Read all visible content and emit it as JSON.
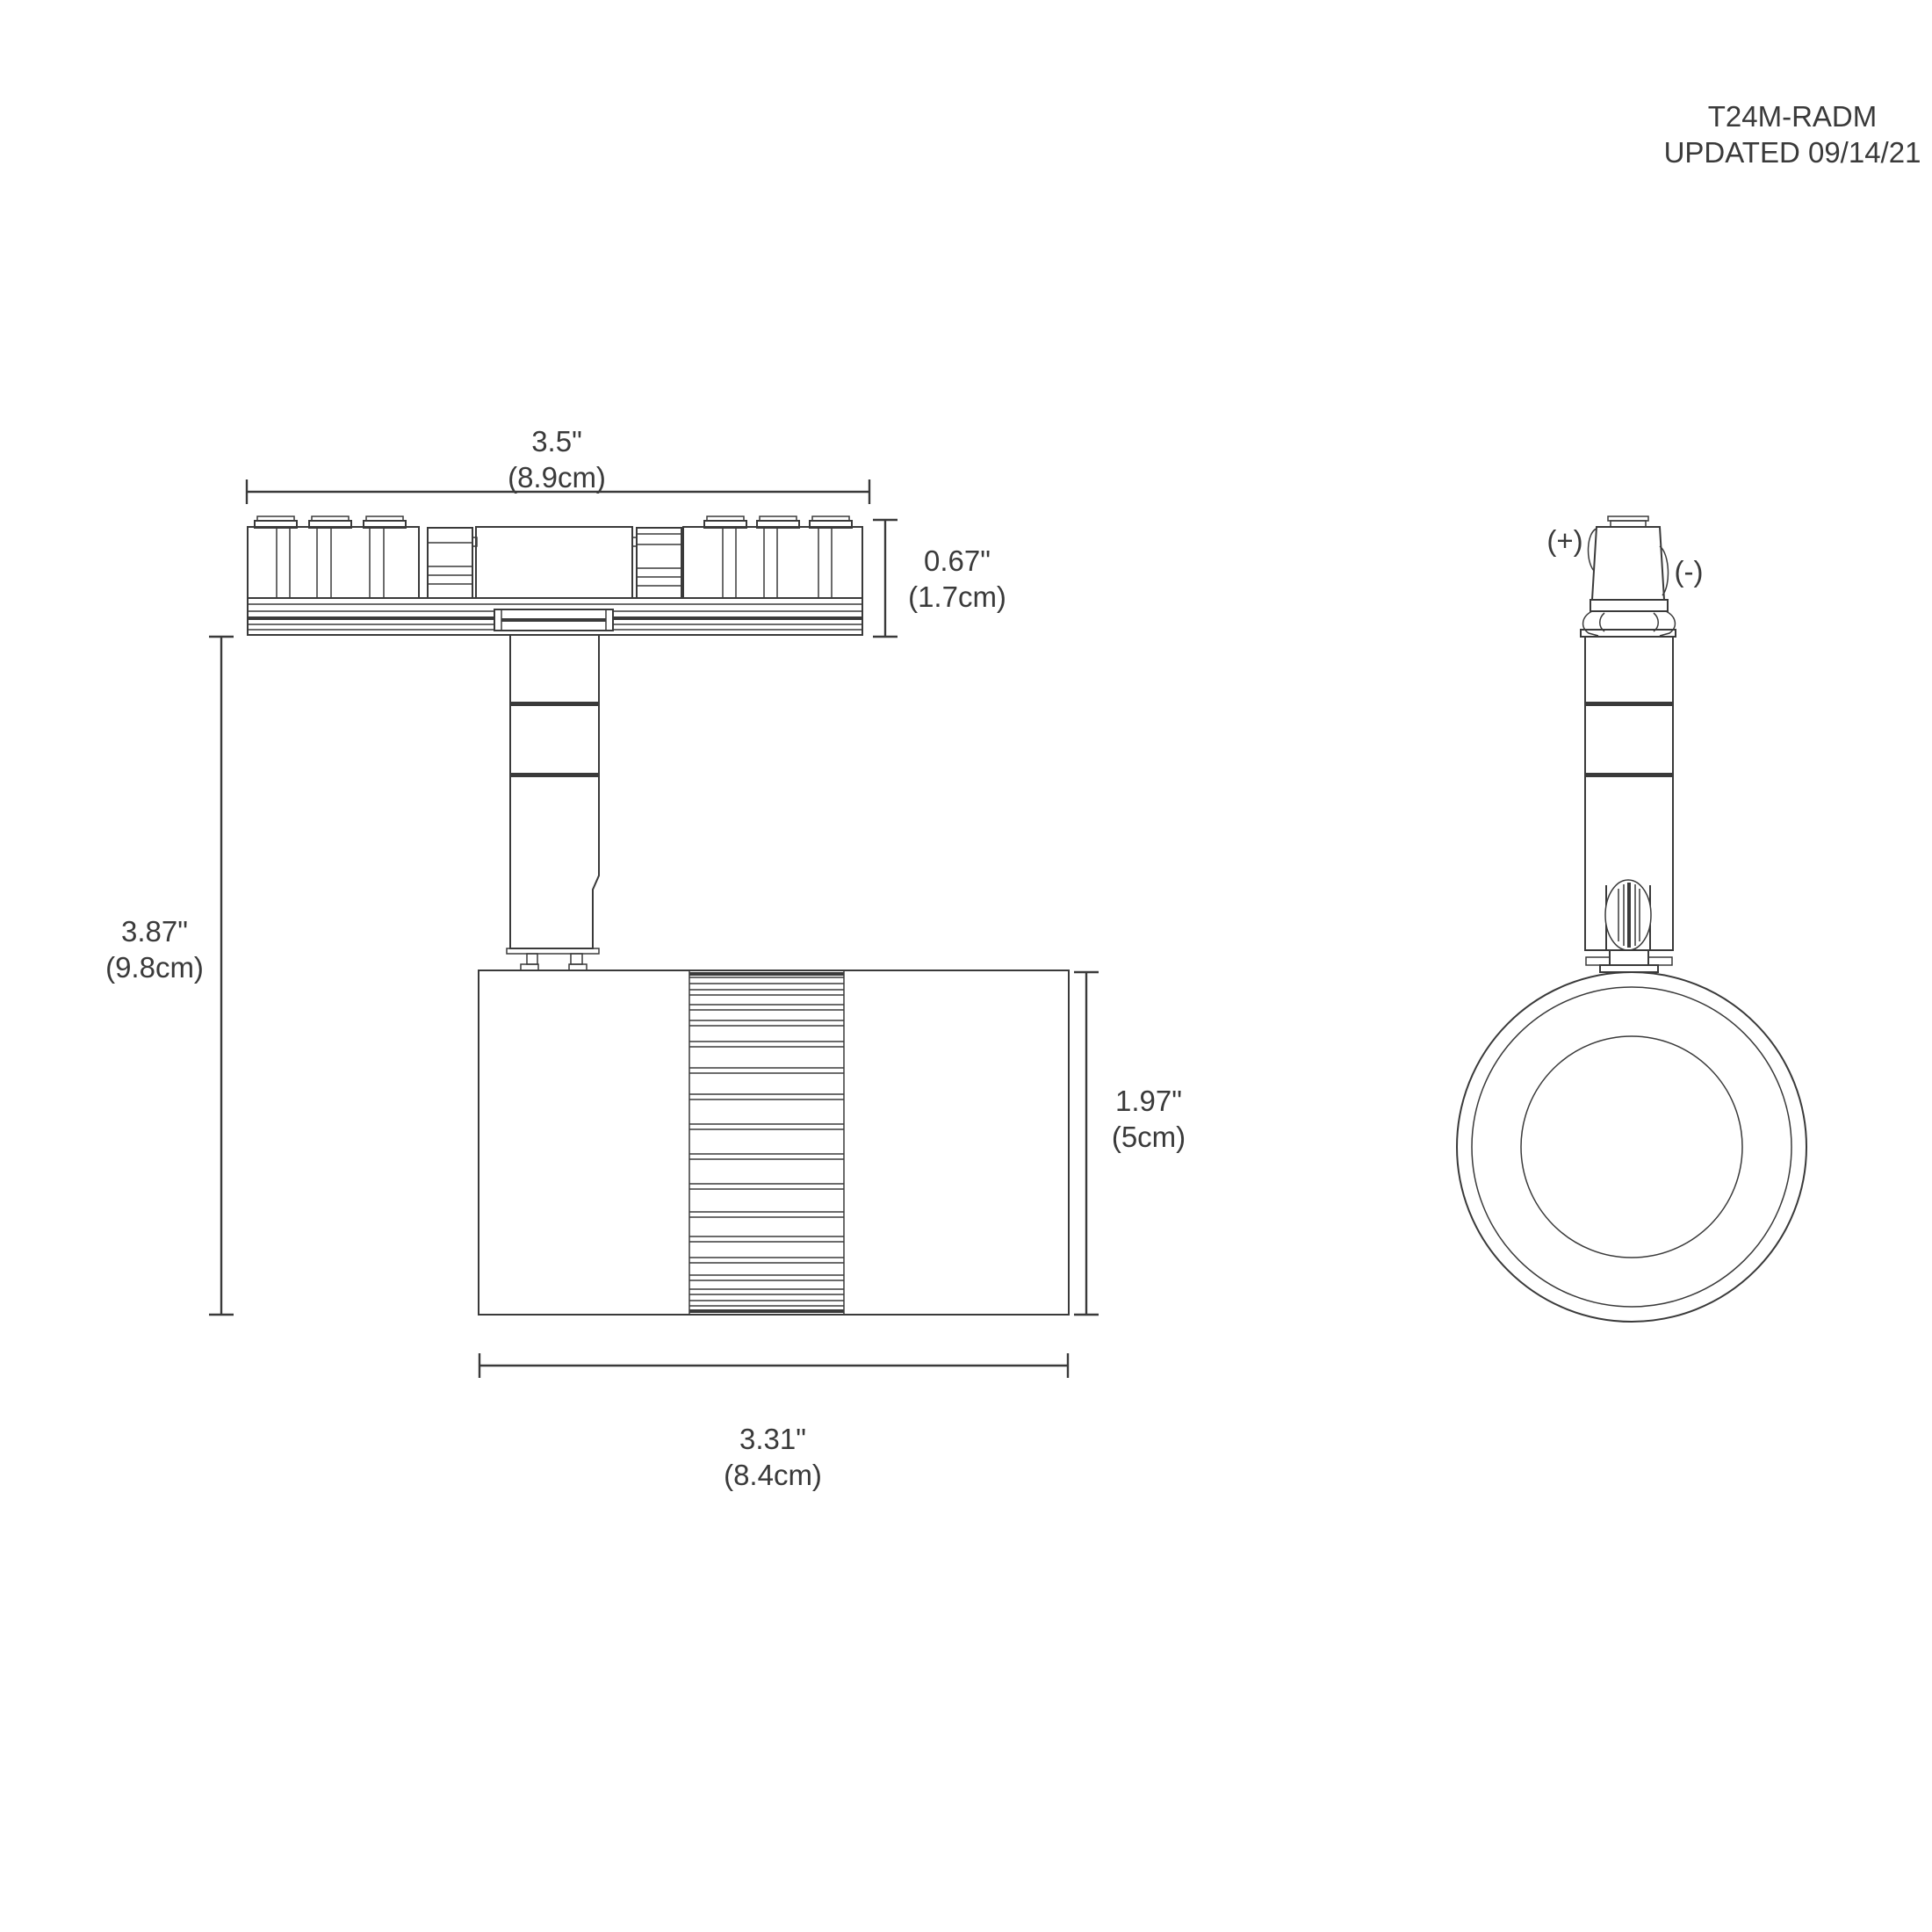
{
  "title_block": {
    "model": "T24M-RADM",
    "updated": "UPDATED 09/14/21"
  },
  "views": {
    "side": {
      "dimensions": {
        "track_width": {
          "inches": "3.5\"",
          "metric": "(8.9cm)"
        },
        "track_height": {
          "inches": "0.67\"",
          "metric": "(1.7cm)"
        },
        "overall_height": {
          "inches": "3.87\"",
          "metric": "(9.8cm)"
        },
        "head_height": {
          "inches": "1.97\"",
          "metric": "(5cm)"
        },
        "head_width": {
          "inches": "3.31\"",
          "metric": "(8.4cm)"
        }
      }
    },
    "front": {
      "polarity": {
        "positive": "(+)",
        "negative": "(-)"
      }
    }
  },
  "colors": {
    "line": "#3a3a3a",
    "background": "#ffffff"
  }
}
